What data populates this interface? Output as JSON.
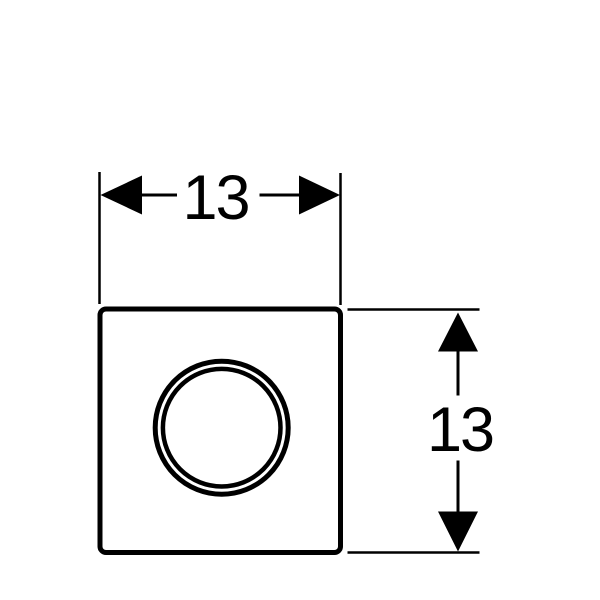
{
  "colors": {
    "ink": "#000000",
    "paper": "#ffffff"
  },
  "figure": {
    "subject": "square-plate-with-concentric-ring",
    "view": "front"
  },
  "dimensions": {
    "width": {
      "label": "13"
    },
    "height": {
      "label": "13"
    }
  }
}
